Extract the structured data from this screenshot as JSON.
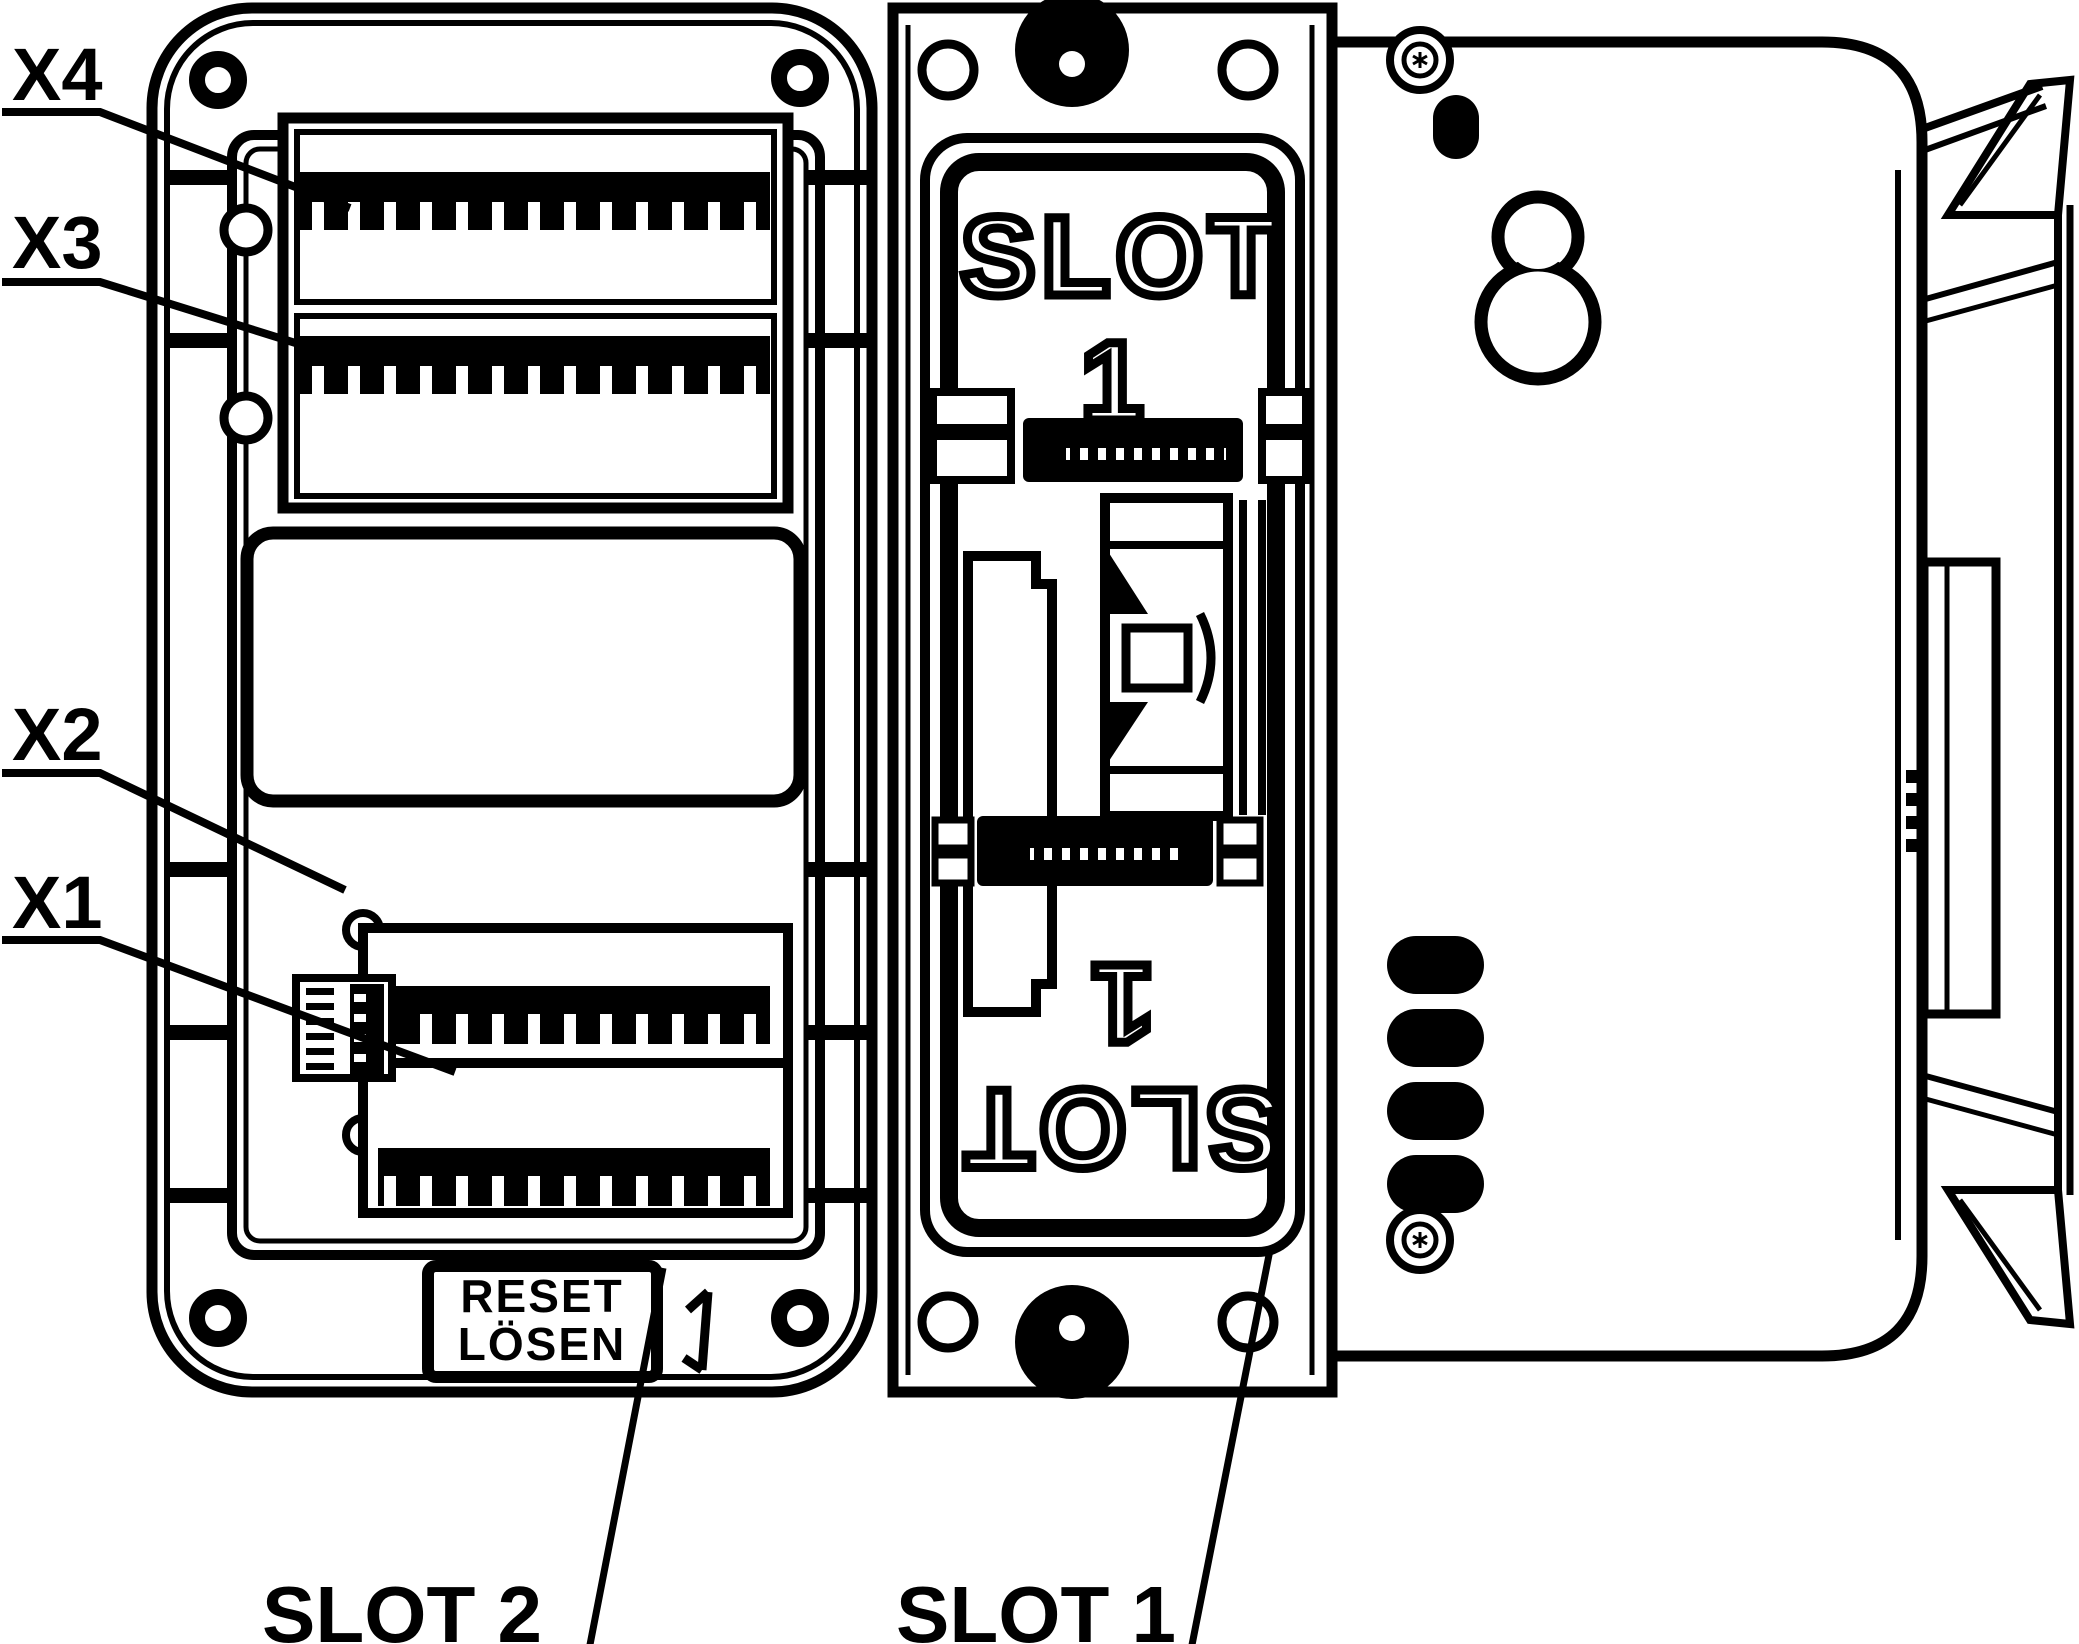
{
  "drawing": {
    "type": "technical-line-drawing",
    "background_color": "#ffffff",
    "line_color": "#000000",
    "callouts": {
      "x4": "X4",
      "x3": "X3",
      "x2": "X2",
      "x1": "X1",
      "slot2": "SLOT 2",
      "slot1": "SLOT 1"
    },
    "slot_marking_top": {
      "word": "SLOT",
      "number": "1"
    },
    "slot_marking_bottom_rotated": {
      "word": "SLOT",
      "number": "1"
    },
    "reset_button": {
      "line1": "RESET",
      "line2": "LÖSEN"
    },
    "shape_glossary": [
      "screw-hole-ring",
      "screw-head-solid",
      "torx-screw",
      "terminal-teeth-row",
      "dip-switch-block",
      "keyhole-wall-mount",
      "led-pill-cutouts",
      "din-rail-clip"
    ]
  }
}
